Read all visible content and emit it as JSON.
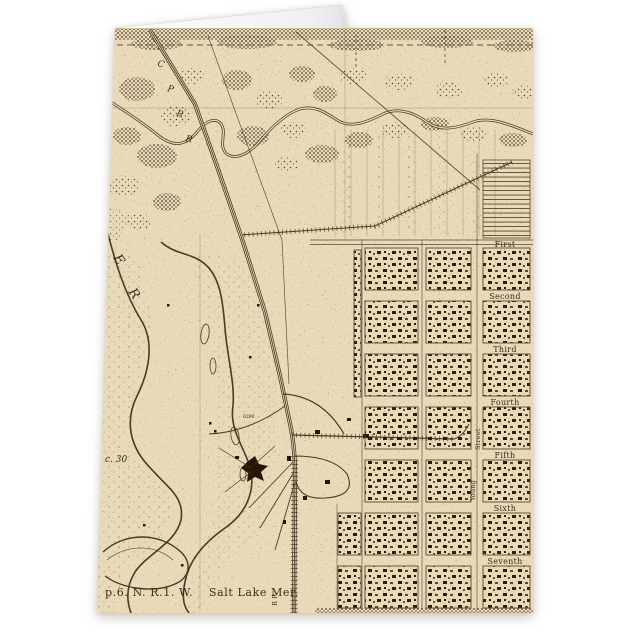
{
  "page": {
    "background": "#ffffff"
  },
  "map": {
    "colors": {
      "paper": "#e9dbba",
      "ink": "#4c3a26",
      "dark_ink": "#27190c",
      "card_back": "#f6f6f8"
    },
    "labels": {
      "township": "p.6. N. R.1. W.",
      "meridian": "Salt Lake Mer.",
      "section": "c. 30",
      "elevation": "6290",
      "railroad_vertical": "R R",
      "railroad_letters": [
        "C",
        "P",
        "R",
        "R"
      ],
      "river_letters": [
        "E",
        "R"
      ],
      "streets": [
        "First",
        "Second",
        "Third",
        "Fourth",
        "Fifth",
        "Sixth",
        "Seventh"
      ],
      "vertical_streets": [
        "Street",
        "Young"
      ]
    }
  }
}
